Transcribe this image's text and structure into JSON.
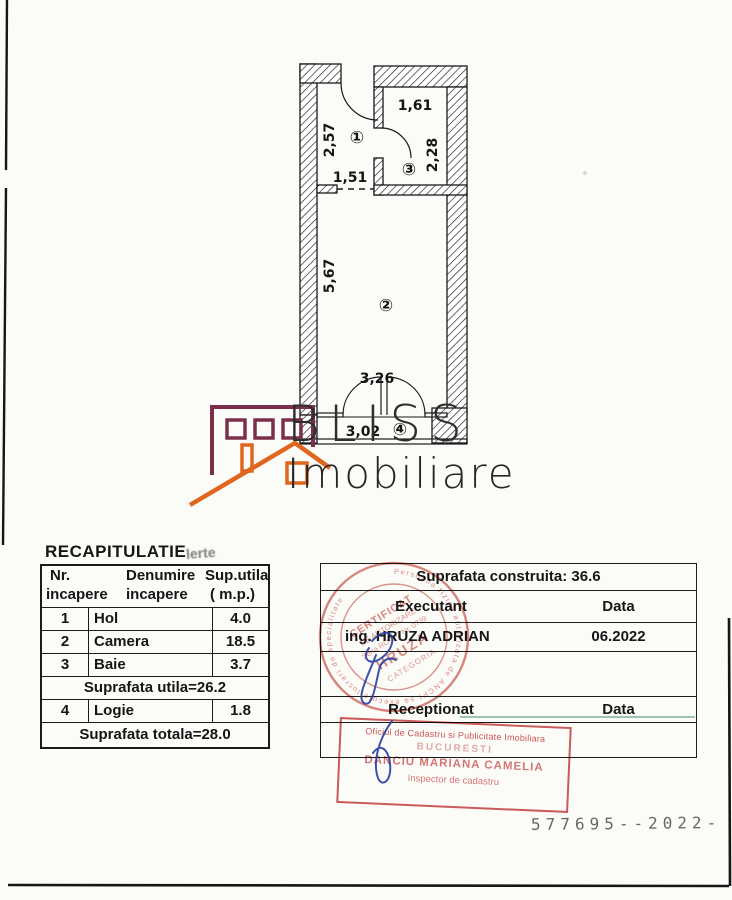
{
  "plan": {
    "room1": {
      "symbol": "①",
      "height": "2,57",
      "width": "1,51"
    },
    "room2": {
      "symbol": "②",
      "height": "5,67",
      "width": "3,26"
    },
    "room3": {
      "symbol": "③",
      "width": "1,61",
      "height": "2,28"
    },
    "room4": {
      "symbol": "④",
      "width": "3,02"
    }
  },
  "logo": {
    "brand": "BLISS",
    "sub": "Imobiliare",
    "house_dark_color": "#7c2f4a",
    "house_orange_color": "#e0661e"
  },
  "recap": {
    "title": "RECAPITULATIE",
    "smudge": "lerte",
    "header": {
      "col1a": "Nr.",
      "col1b": "incapere",
      "col2a": "Denumire",
      "col2b": "incapere",
      "col3a": "Sup.utila",
      "col3b": "( m.p.)"
    },
    "rows": [
      {
        "nr": "1",
        "name": "Hol",
        "area": "4.0"
      },
      {
        "nr": "2",
        "name": "Camera",
        "area": "18.5"
      },
      {
        "nr": "3",
        "name": "Baie",
        "area": "3.7"
      }
    ],
    "subtotal": "Suprafata utila=26.2",
    "row4": {
      "nr": "4",
      "name": "Logie",
      "area": "1.8"
    },
    "total": "Suprafata totala=28.0"
  },
  "exec_table": {
    "built_area": "Suprafata construita: 36.6",
    "executant_label": "Executant",
    "data_label": "Data",
    "executant_value": "ing. HRUZA ADRIAN",
    "data_value": "06.2022",
    "receptionat_label": "Receptionat",
    "data_label2": "Data"
  },
  "round_stamp": {
    "rim": "Persoana fizica autorizata de ANCPI sa execute lucrari de specialitate",
    "center1": "CERTIFICAT",
    "center2": "DE AUTORIZARE",
    "center3": "Seria RO-B-J Nr. 0739",
    "name": "HRUZA",
    "center4": "CATEGORIA",
    "stamp_color": "#c0392b"
  },
  "rect_stamp": {
    "line1": "Oficiul de Cadastru si Publicitate Imobiliara",
    "line2": "BUCURESTI",
    "line3": "DANCIU MARIANA CAMELIA",
    "line4": "Inspector de cadastru",
    "stamp_color": "#c74a4a"
  },
  "signature_color": "#2a3e9f",
  "footer": {
    "serial": "577695--2022-"
  }
}
